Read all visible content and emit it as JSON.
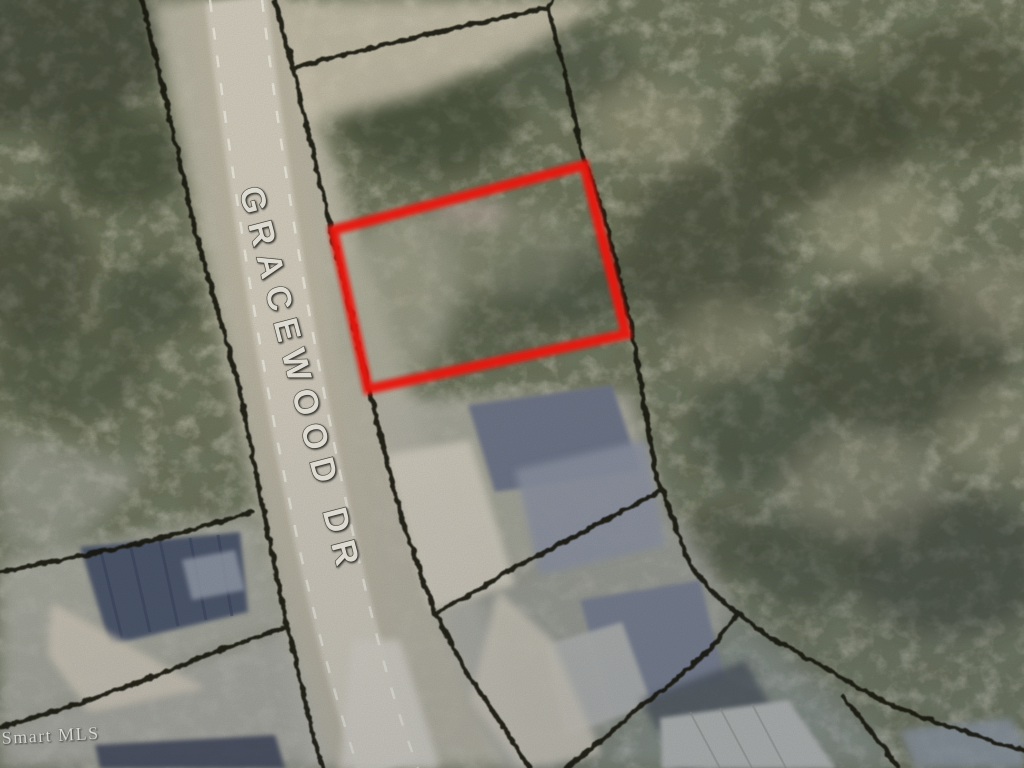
{
  "page": {
    "title": "Aerial parcel map with highlighted lot"
  },
  "map": {
    "street_label": "GRACEWOOD DR",
    "watermark": "Smart MLS",
    "subject_parcel": {
      "highlight_color": "#e8170c",
      "points": "333,230 584,165 626,334 368,389"
    },
    "boundary_color": "#17160f",
    "road_color": "#d0cabb"
  }
}
